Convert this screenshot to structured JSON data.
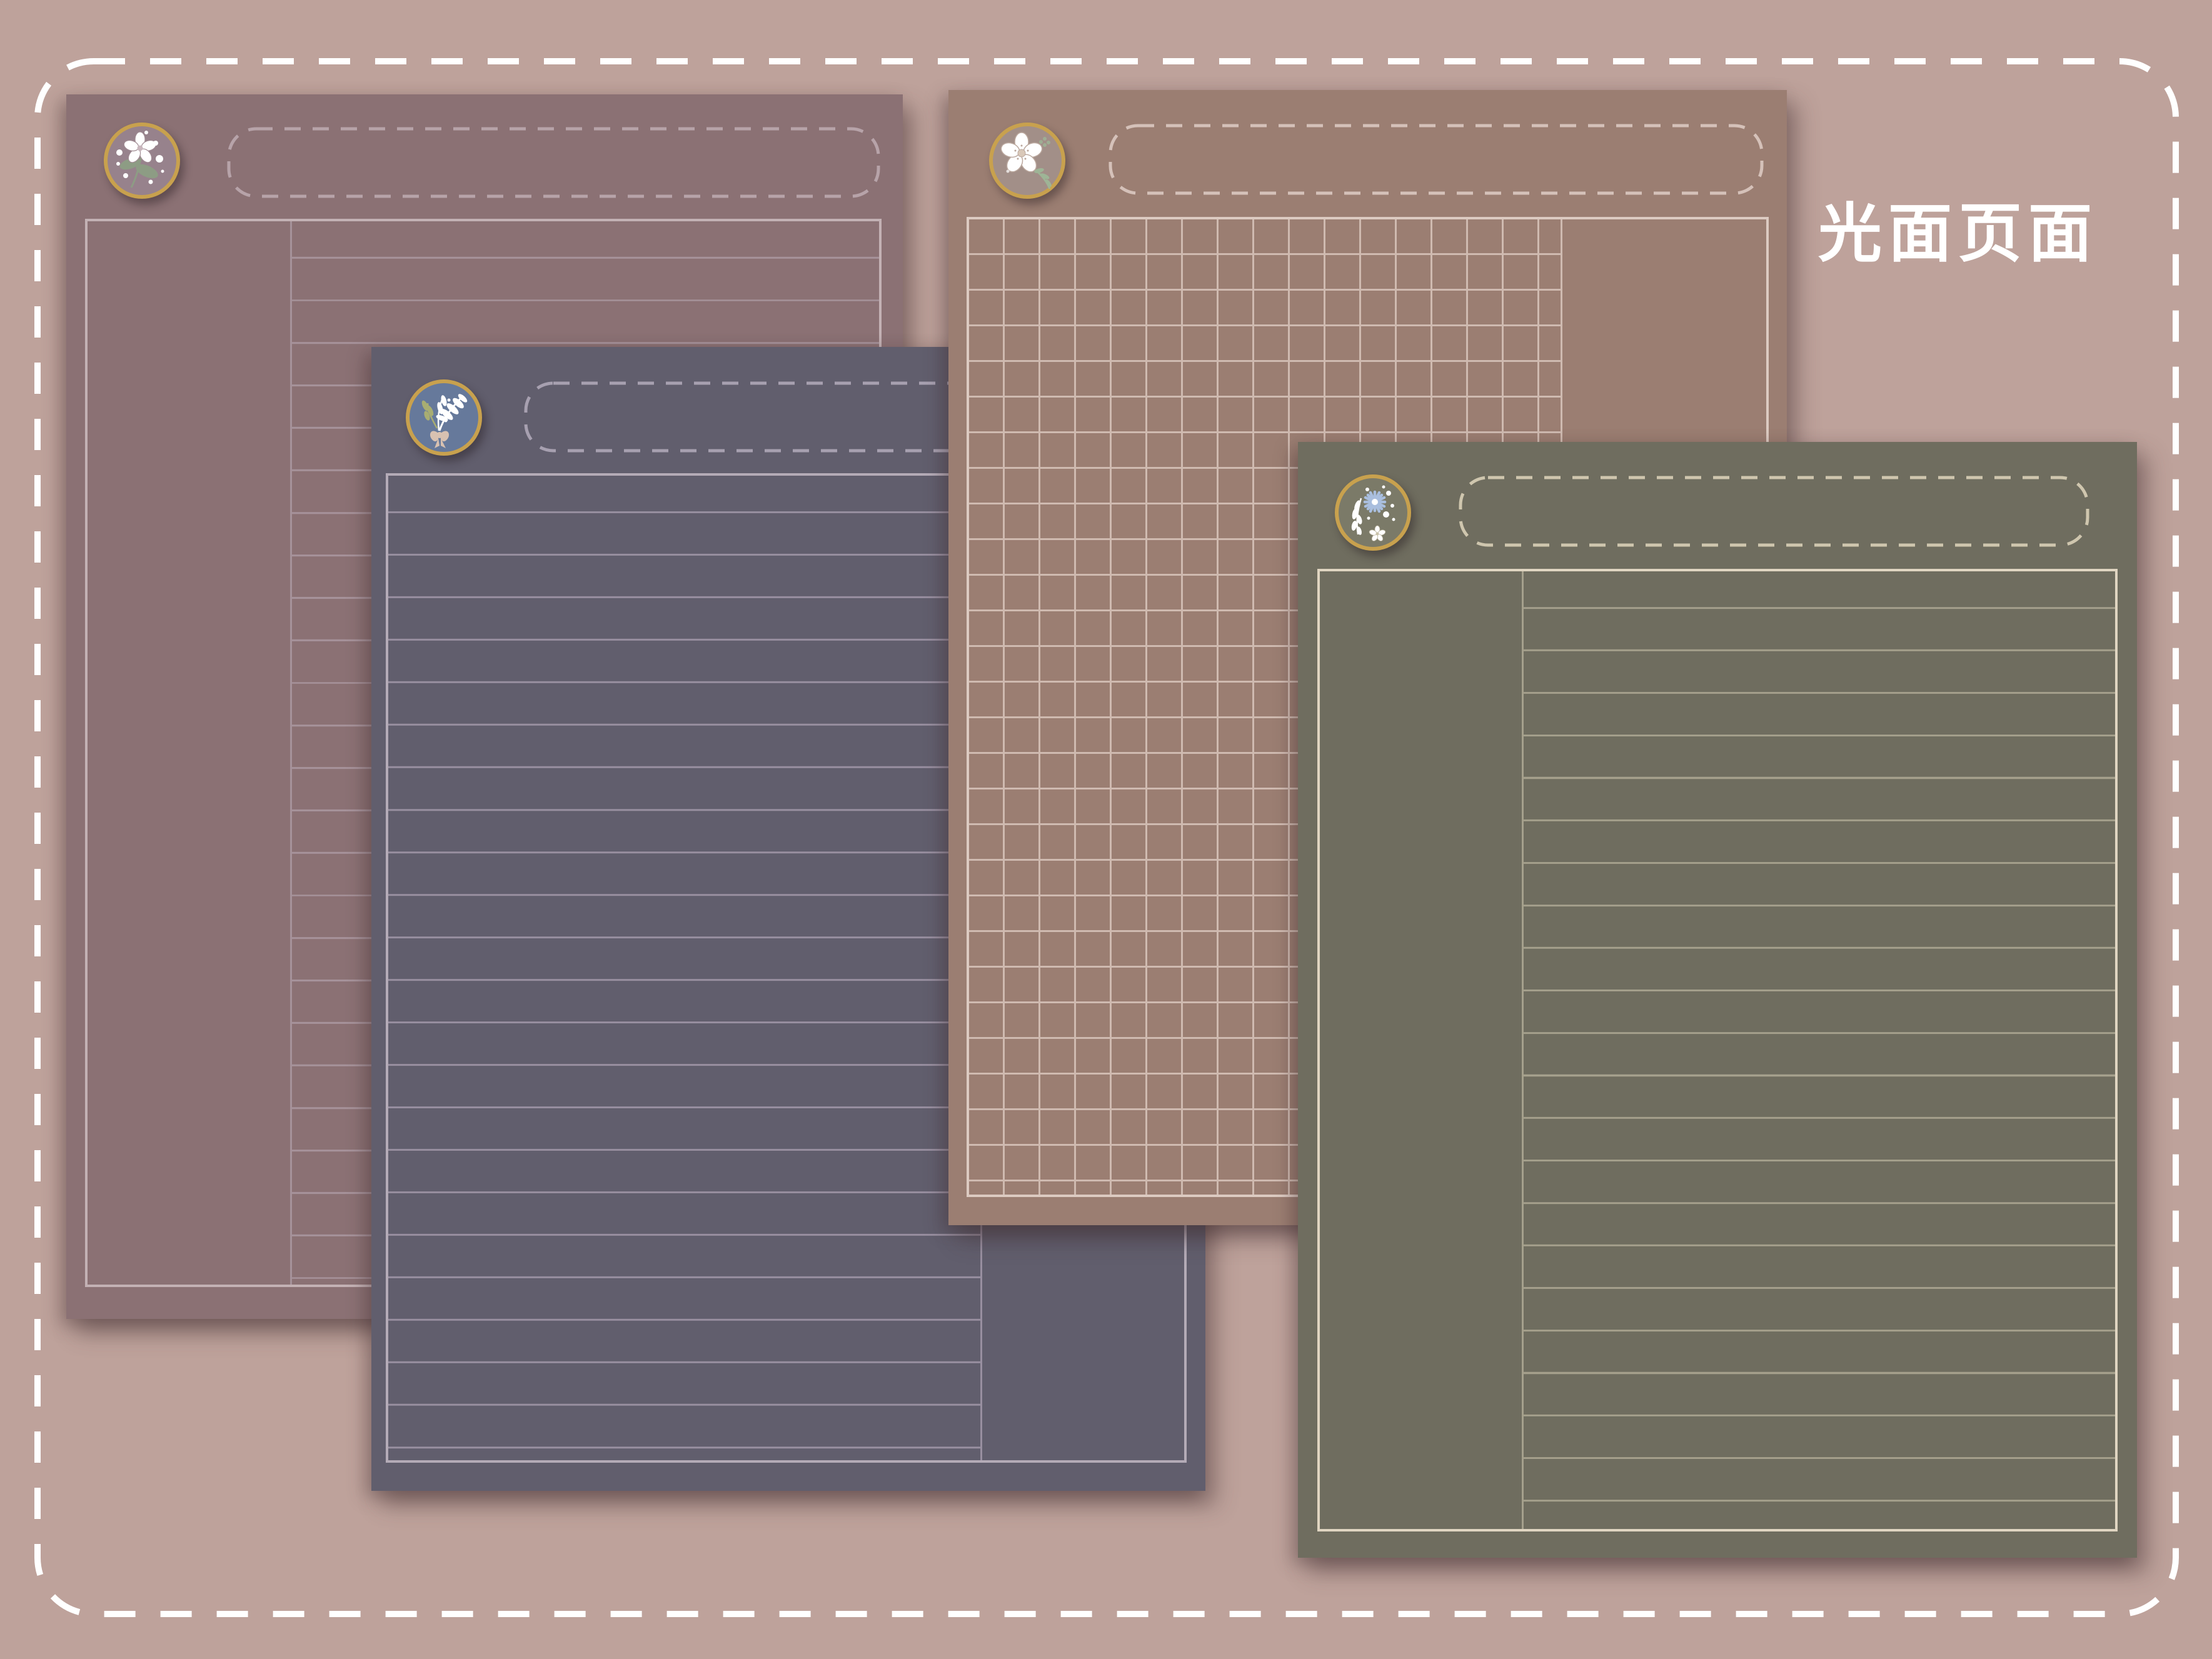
{
  "canvas": {
    "background_color": "#bea29b",
    "dashed_border_color": "#ffffff",
    "caption": "光面页面",
    "caption_color": "#ffffff"
  },
  "pages": [
    {
      "name": "mauve-lined-page",
      "ruling": "lined",
      "blank_column": "left",
      "badge_icon": "plum-blossom-branch-icon",
      "colors": {
        "bg": "#8b7174",
        "border": "#c3b1b4",
        "line": "#a6929a",
        "dash": "#b7a3a9",
        "badge_bg": "#97828c",
        "ring": "#c8a14e"
      }
    },
    {
      "name": "slate-lined-page",
      "ruling": "lined",
      "blank_column": "right",
      "badge_icon": "leaf-bouquet-bow-icon",
      "colors": {
        "bg": "#615e6d",
        "border": "#b4abb7",
        "line": "#988fa0",
        "dash": "#a7a0b0",
        "badge_bg": "#66799b",
        "ring": "#c8a14e"
      }
    },
    {
      "name": "brown-grid-page",
      "ruling": "grid",
      "blank_column": "right",
      "badge_icon": "sakura-flower-icon",
      "colors": {
        "bg": "#9b7e72",
        "border": "#dccac1",
        "line": "#cfbab0",
        "dash": "#d5c1b9",
        "badge_bg": "#a28f88",
        "ring": "#c8a14e"
      }
    },
    {
      "name": "olive-lined-page",
      "ruling": "lined",
      "blank_column": "left",
      "badge_icon": "aster-flower-icon",
      "colors": {
        "bg": "#6f6d5f",
        "border": "#e0d5c1",
        "line": "#a5a08c",
        "dash": "#cfc6ae",
        "badge_bg": "#7b7a68",
        "ring": "#c8a14e"
      }
    }
  ]
}
